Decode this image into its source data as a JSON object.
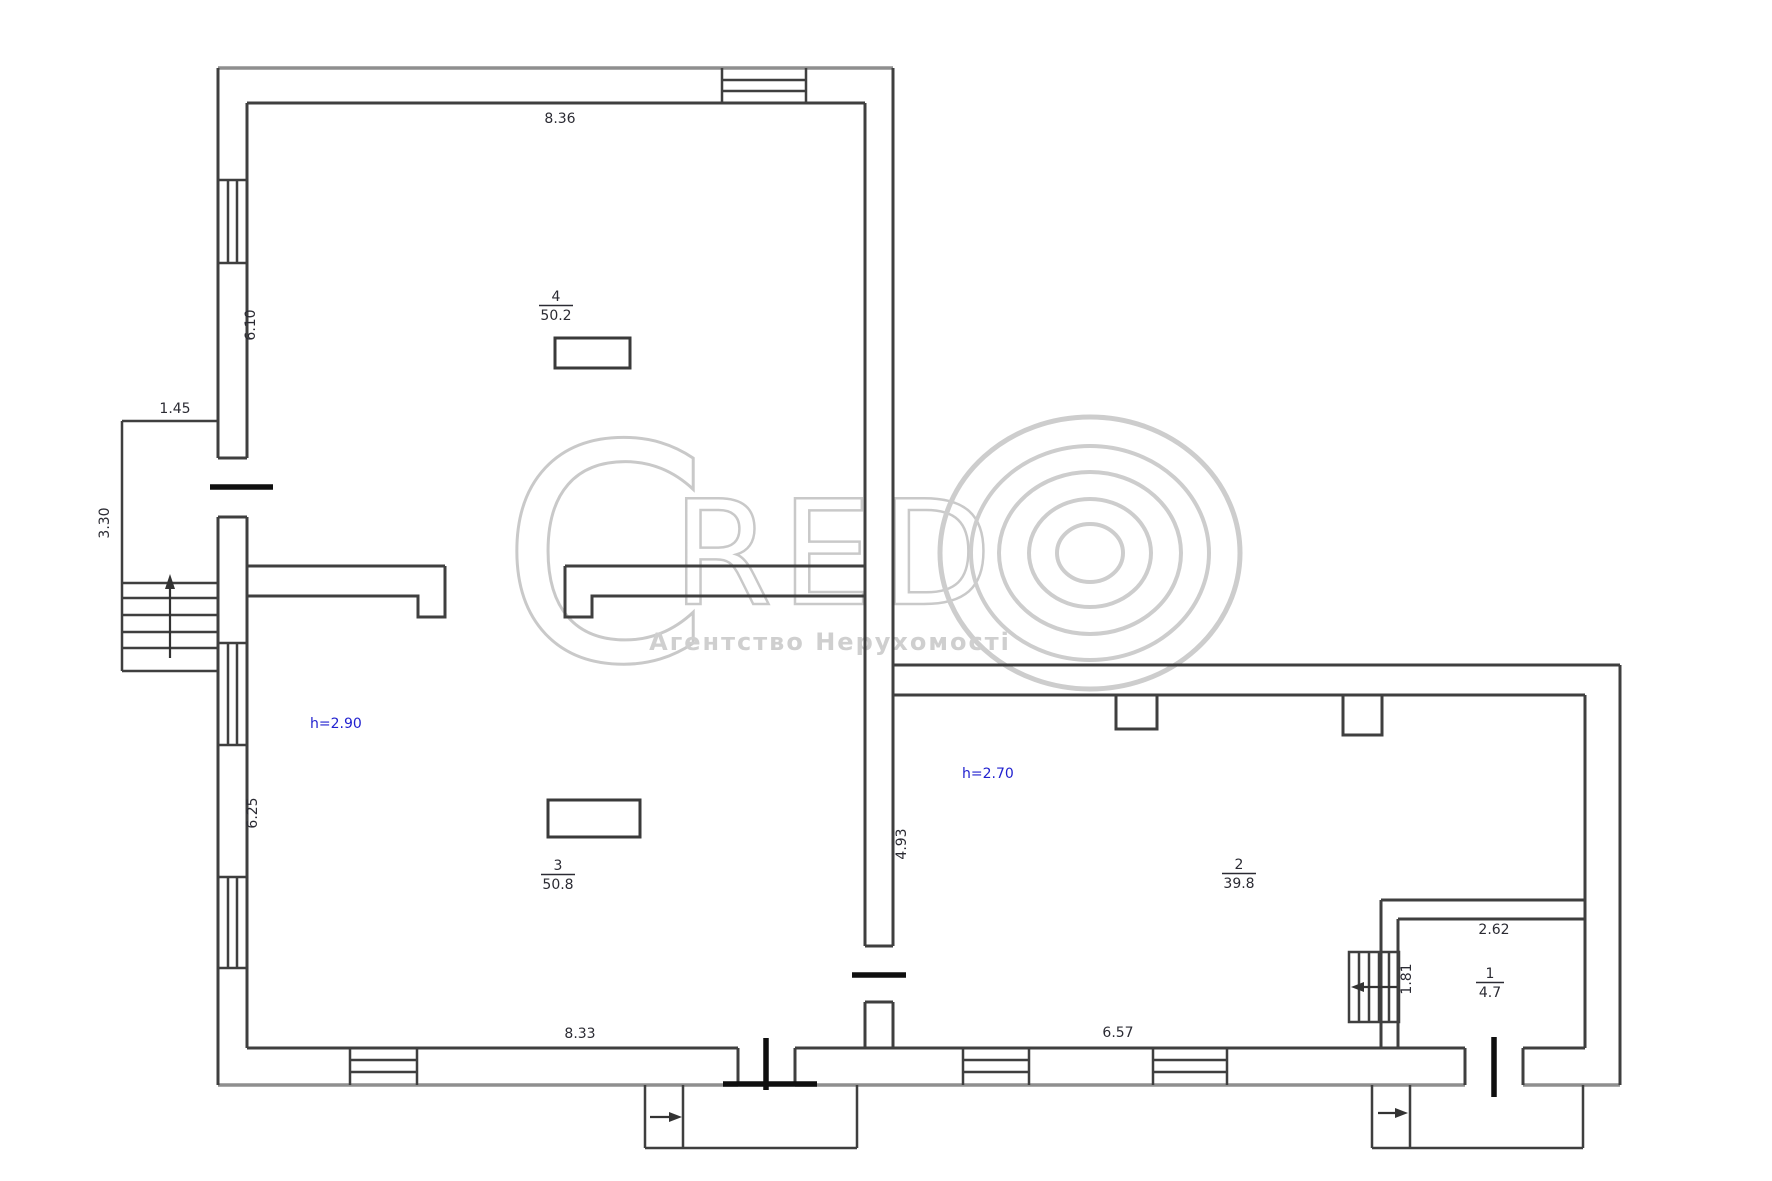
{
  "watermark": {
    "logo_c": "C",
    "logo_letters": "RED",
    "tagline": "Агентство Нерухомості"
  },
  "rooms": [
    {
      "number": "4",
      "area": "50.2"
    },
    {
      "number": "3",
      "area": "50.8"
    },
    {
      "number": "2",
      "area": "39.8"
    },
    {
      "number": "1",
      "area": "4.7"
    }
  ],
  "height_notes": [
    {
      "text": "h=2.90"
    },
    {
      "text": "h=2.70"
    }
  ],
  "dimensions": {
    "room4_width": "8.36",
    "room4_depth": "6.10",
    "porch_width": "1.45",
    "porch_depth": "3.30",
    "room3_depth": "6.25",
    "room3_width": "8.33",
    "room2_depth": "4.93",
    "room2_width": "6.57",
    "room1_width": "2.62",
    "room1_depth": "1.81"
  },
  "colors": {
    "dimension_text": "#2b2b33",
    "height_text": "#2222cf",
    "watermark_gray": "#c9c9c9",
    "wall_dark": "#3f3f3f",
    "wall_outer_gray": "#8f8f8f"
  }
}
